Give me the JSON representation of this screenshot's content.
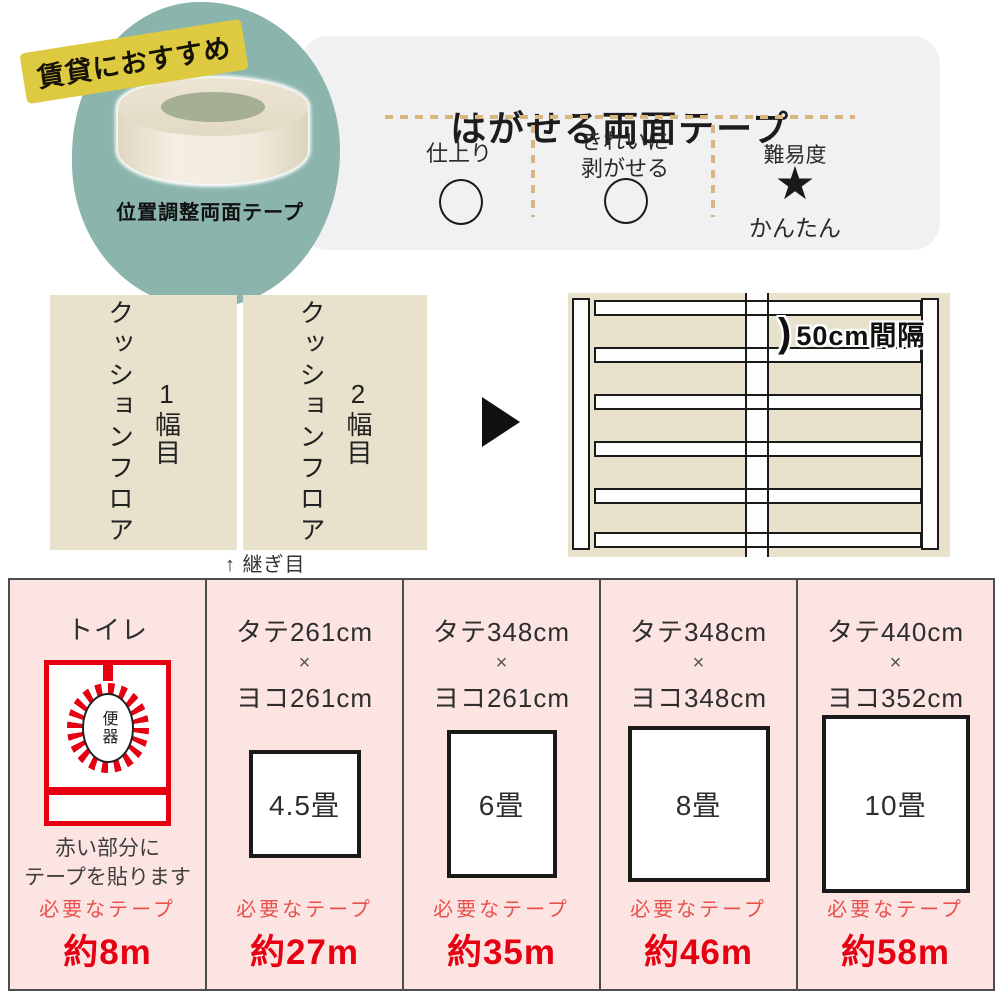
{
  "badge": {
    "label": "賃貸におすすめ"
  },
  "hero": {
    "product_label": "位置調整両面テープ"
  },
  "feature_box": {
    "title": "はがせる両面テープ",
    "col1": {
      "label": "仕上り",
      "rating_icon": "circle"
    },
    "col2": {
      "line1": "きれいに",
      "line2": "剥がせる",
      "rating_icon": "circle"
    },
    "col3": {
      "label": "難易度",
      "star_icon": "★",
      "level": "かんたん"
    }
  },
  "panels": {
    "panel1": {
      "text": "クッションフロア",
      "num": "1幅目"
    },
    "panel2": {
      "text": "クッションフロア",
      "num": "2幅目"
    },
    "seam_note": "↑ 継ぎ目"
  },
  "diagram": {
    "spacing_bracket": ")",
    "spacing_label": "50cm間隔"
  },
  "table": {
    "cols": [
      {
        "title": "トイレ",
        "bowl_label": "便器",
        "note1": "赤い部分に",
        "note2": "テープを貼ります",
        "tape_label": "必要なテープ",
        "amount": "約8m"
      },
      {
        "line1": "タテ261cm",
        "times": "×",
        "line2": "ヨコ261cm",
        "room": "4.5畳",
        "tape_label": "必要なテープ",
        "amount": "約27m"
      },
      {
        "line1": "タテ348cm",
        "times": "×",
        "line2": "ヨコ261cm",
        "room": "6畳",
        "tape_label": "必要なテープ",
        "amount": "約35m"
      },
      {
        "line1": "タテ348cm",
        "times": "×",
        "line2": "ヨコ348cm",
        "room": "8畳",
        "tape_label": "必要なテープ",
        "amount": "約46m"
      },
      {
        "line1": "タテ440cm",
        "times": "×",
        "line2": "ヨコ352cm",
        "room": "10畳",
        "tape_label": "必要なテープ",
        "amount": "約58m"
      }
    ]
  },
  "colors": {
    "red": "#e60012",
    "redsoft": "#e8514d",
    "teal": "#8ab4ac",
    "yellow": "#ddca41",
    "beige": "#e8e1cb",
    "pink": "#fce4e2",
    "tan": "#dbb57f",
    "ink": "#3a3a3a",
    "graybox": "#f1f1f2"
  }
}
